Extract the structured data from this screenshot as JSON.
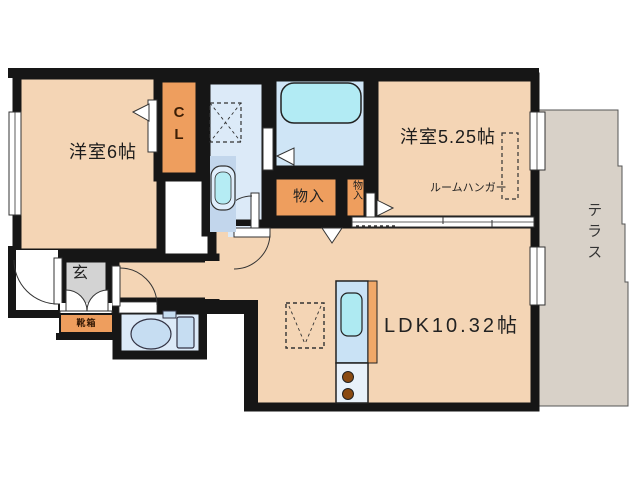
{
  "title": "apartment-floor-plan",
  "labels": {
    "bedroom1": "洋室6帖",
    "closet_line1": "C",
    "closet_line2": "L",
    "bedroom2": "洋室5.25帖",
    "room_hanger": "ルームハンガー",
    "terrace": "テラス",
    "ldk": "LDK10.32帖",
    "storage_main": "物入",
    "storage_small": "物入",
    "entrance": "玄",
    "shoe_box": "靴箱"
  },
  "colors": {
    "wall": "#161616",
    "room_peach": "#f4d5b5",
    "closet_orange": "#ee9e5e",
    "wet_area_blue": "#dceaf8",
    "bath_blue": "#cfe5f6",
    "bathtub_cyan": "#b2ebf4",
    "sink_cyan": "#aeeaf2",
    "terrace_gray": "#d8d1c8",
    "entrance_gray": "#d3d3d3",
    "kitchen_counter": "#c9e2f5",
    "burner_brown": "#8a4a12"
  }
}
